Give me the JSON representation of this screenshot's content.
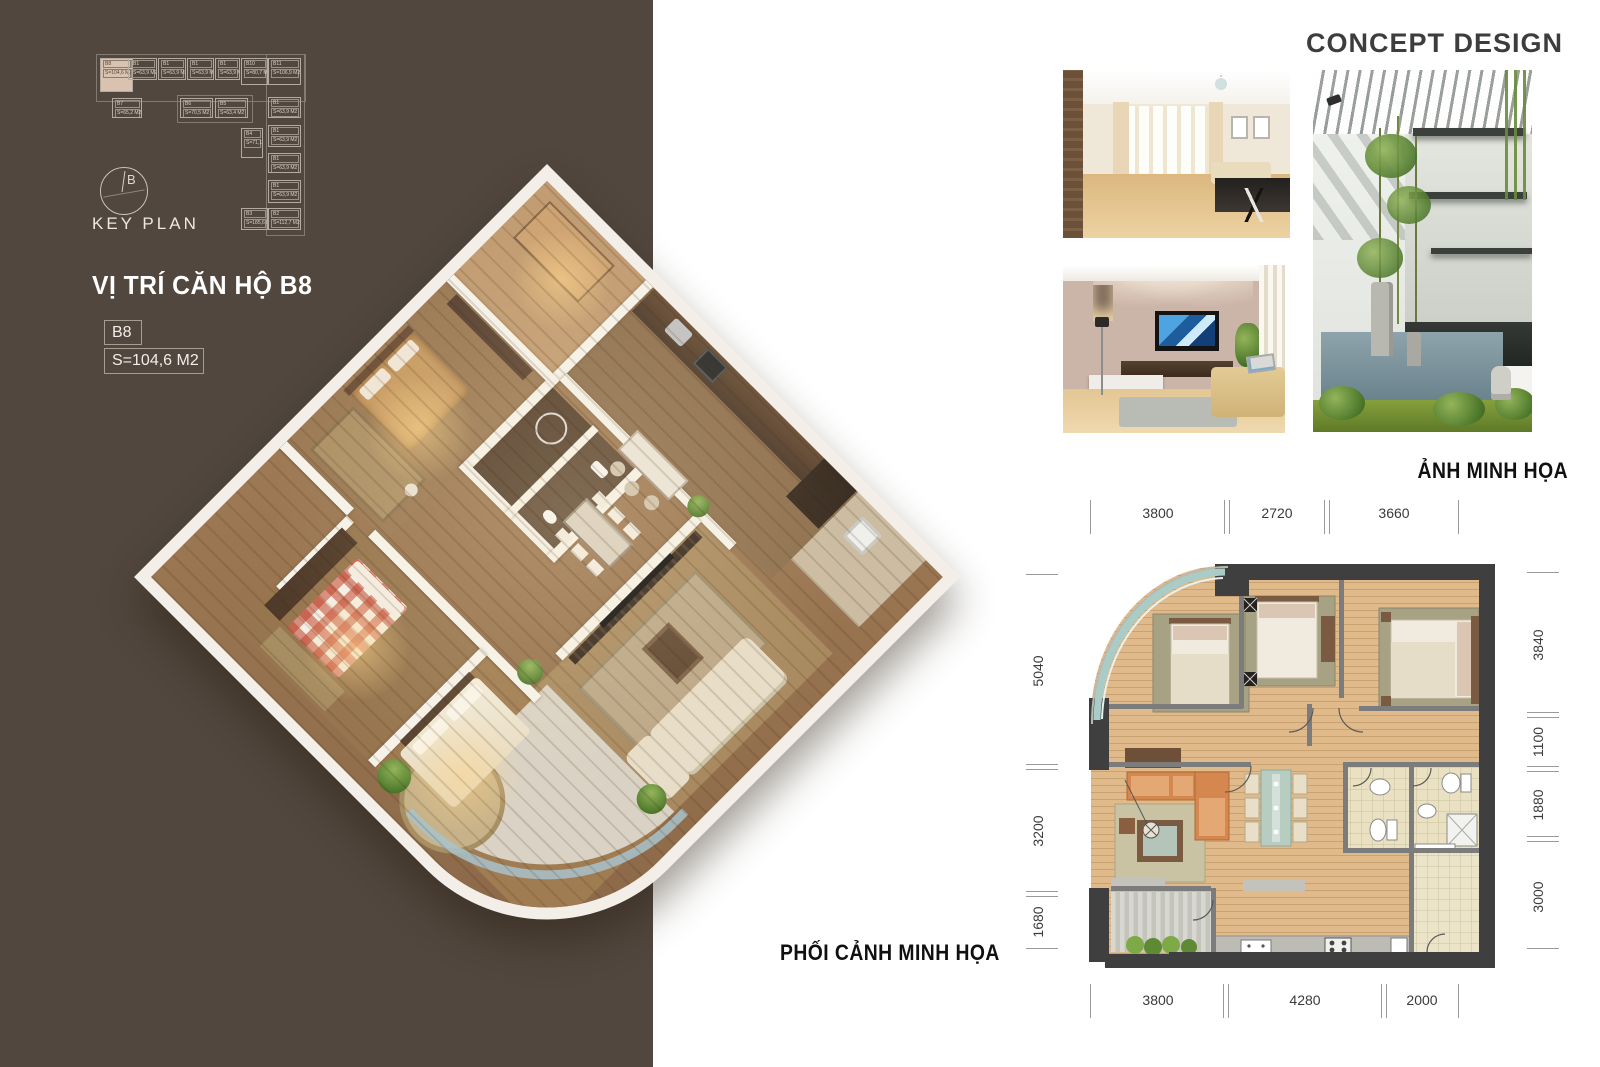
{
  "left_panel": {
    "title": "VỊ TRÍ CĂN HỘ B8",
    "unit_code": "B8",
    "unit_area": "S=104,6 M2"
  },
  "keyplan": {
    "label": "KEY PLAN",
    "compass_letter": "B",
    "units": [
      {
        "id": "B8",
        "area": "S=104,6 M2",
        "x": 20,
        "y": 18,
        "w": 33,
        "h": 34,
        "hl": true
      },
      {
        "id": "B1",
        "area": "S=63,9 M2",
        "x": 48,
        "y": 18,
        "w": 29,
        "h": 22
      },
      {
        "id": "B1",
        "area": "S=63,9 M2",
        "x": 78,
        "y": 18,
        "w": 28,
        "h": 22
      },
      {
        "id": "B1",
        "area": "S=63,9 M2",
        "x": 107,
        "y": 18,
        "w": 27,
        "h": 22
      },
      {
        "id": "B1",
        "area": "S=63,9 M2",
        "x": 135,
        "y": 18,
        "w": 25,
        "h": 22
      },
      {
        "id": "B10",
        "area": "S=80,7 M2",
        "x": 161,
        "y": 18,
        "w": 27,
        "h": 27
      },
      {
        "id": "B11",
        "area": "S=106,9 M2",
        "x": 188,
        "y": 18,
        "w": 33,
        "h": 27
      },
      {
        "id": "B7",
        "area": "S=65,2 M2",
        "x": 32,
        "y": 58,
        "w": 30,
        "h": 20
      },
      {
        "id": "B6",
        "area": "S=70,5 M2",
        "x": 100,
        "y": 58,
        "w": 33,
        "h": 20
      },
      {
        "id": "B5",
        "area": "S=63,4 M2",
        "x": 135,
        "y": 58,
        "w": 33,
        "h": 20
      },
      {
        "id": "B4",
        "area": "S=71,1 M2",
        "x": 161,
        "y": 88,
        "w": 22,
        "h": 30
      },
      {
        "id": "B1",
        "area": "S=63,9 M2",
        "x": 188,
        "y": 57,
        "w": 33,
        "h": 21
      },
      {
        "id": "B1",
        "area": "S=63,9 M2",
        "x": 188,
        "y": 85,
        "w": 33,
        "h": 22
      },
      {
        "id": "B1",
        "area": "S=63,9 M2",
        "x": 188,
        "y": 113,
        "w": 33,
        "h": 20
      },
      {
        "id": "B1",
        "area": "S=63,9 M2",
        "x": 188,
        "y": 140,
        "w": 33,
        "h": 23
      },
      {
        "id": "B3",
        "area": "S=185,6 M2",
        "x": 161,
        "y": 168,
        "w": 27,
        "h": 22
      },
      {
        "id": "B2",
        "area": "S=112,7 M2",
        "x": 188,
        "y": 168,
        "w": 33,
        "h": 22
      }
    ]
  },
  "right": {
    "heading": "CONCEPT DESIGN",
    "photos_caption": "ẢNH MINH HỌA",
    "photo_watermark": "design"
  },
  "bottom": {
    "plan_caption": "PHỐI CẢNH MINH HỌA"
  },
  "floorplan": {
    "dims_top": [
      "3800",
      "2720",
      "3660"
    ],
    "dims_bottom": [
      "3800",
      "4280",
      "2000"
    ],
    "dims_left": [
      "5040",
      "3200",
      "1680"
    ],
    "dims_right": [
      "3840",
      "1100",
      "1880",
      "3000"
    ]
  }
}
